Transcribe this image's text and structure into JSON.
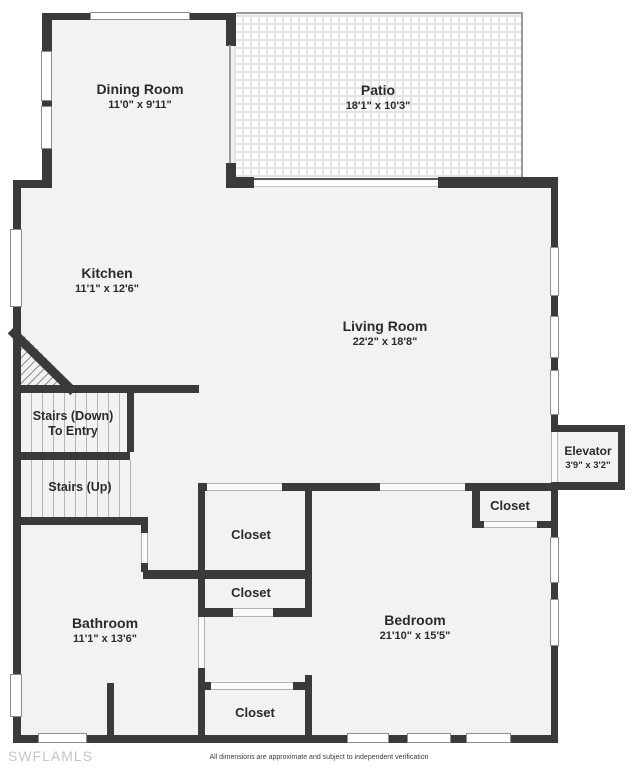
{
  "rooms": {
    "dining": {
      "name": "Dining Room",
      "dims": "11'0\" x 9'11\""
    },
    "patio": {
      "name": "Patio",
      "dims": "18'1\" x 10'3\""
    },
    "kitchen": {
      "name": "Kitchen",
      "dims": "11'1\" x 12'6\""
    },
    "living": {
      "name": "Living Room",
      "dims": "22'2\" x 18'8\""
    },
    "stairs_down": {
      "line1": "Stairs (Down)",
      "line2": "To Entry"
    },
    "stairs_up": {
      "name": "Stairs (Up)"
    },
    "elevator": {
      "name": "Elevator",
      "dims": "3'9\" x 3'2\""
    },
    "closet_hall_upper": {
      "name": "Closet"
    },
    "closet_hall_lower": {
      "name": "Closet"
    },
    "closet_bedroom_right": {
      "name": "Closet"
    },
    "closet_bedroom_bottom": {
      "name": "Closet"
    },
    "bathroom": {
      "name": "Bathroom",
      "dims": "11'1\" x 13'6\""
    },
    "bedroom": {
      "name": "Bedroom",
      "dims": "21'10\" x 15'5\""
    }
  },
  "footer": {
    "watermark": "SWFLAMLS",
    "disclaimer": "All dimensions are approximate and subject to independent verification"
  },
  "colors": {
    "wall": "#3a3a3a",
    "floor": "#f2f2f2",
    "patio_grid": "#e3e3e3",
    "watermark": "#c6c6c6"
  }
}
